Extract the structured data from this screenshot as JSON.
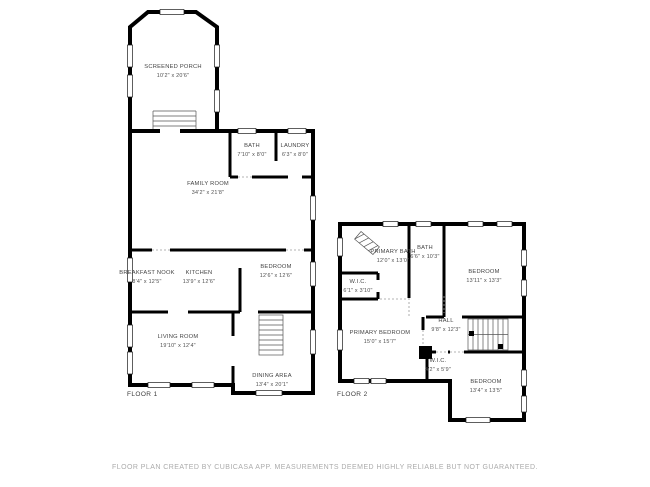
{
  "footer": {
    "text": "FLOOR PLAN CREATED BY CUBICASA APP. MEASUREMENTS DEEMED HIGHLY RELIABLE BUT NOT GUARANTEED."
  },
  "floor1": {
    "label": "FLOOR 1",
    "rooms": {
      "screened_porch": {
        "name": "SCREENED PORCH",
        "dims": "10'2\" x 20'6\""
      },
      "bath": {
        "name": "BATH",
        "dims": "7'10\" x 8'0\""
      },
      "laundry": {
        "name": "LAUNDRY",
        "dims": "6'3\" x 8'0\""
      },
      "family_room": {
        "name": "FAMILY ROOM",
        "dims": "34'2\" x 21'8\""
      },
      "breakfast_nook": {
        "name": "BREAKFAST NOOK",
        "dims": "8'4\" x 12'5\""
      },
      "kitchen": {
        "name": "KITCHEN",
        "dims": "13'9\" x 12'6\""
      },
      "bedroom": {
        "name": "BEDROOM",
        "dims": "12'6\" x 12'6\""
      },
      "living_room": {
        "name": "LIVING ROOM",
        "dims": "19'10\" x 12'4\""
      },
      "dining_area": {
        "name": "DINING AREA",
        "dims": "13'4\" x 20'1\""
      }
    }
  },
  "floor2": {
    "label": "FLOOR 2",
    "rooms": {
      "primary_bath": {
        "name": "PRIMARY BATH",
        "dims": "12'0\" x 13'0\""
      },
      "bath": {
        "name": "BATH",
        "dims": "6'6\" x 10'3\""
      },
      "bedroom_upper": {
        "name": "BEDROOM",
        "dims": "13'11\" x 13'3\""
      },
      "wic_upper": {
        "name": "W.I.C.",
        "dims": "6'1\" x 3'10\""
      },
      "primary_bedroom": {
        "name": "PRIMARY BEDROOM",
        "dims": "15'0\" x 15'7\""
      },
      "hall": {
        "name": "HALL",
        "dims": "9'8\" x 12'3\""
      },
      "wic_lower": {
        "name": "W.I.C.",
        "dims": "4'2\" x 5'9\""
      },
      "bedroom_lower": {
        "name": "BEDROOM",
        "dims": "13'4\" x 13'5\""
      }
    }
  }
}
